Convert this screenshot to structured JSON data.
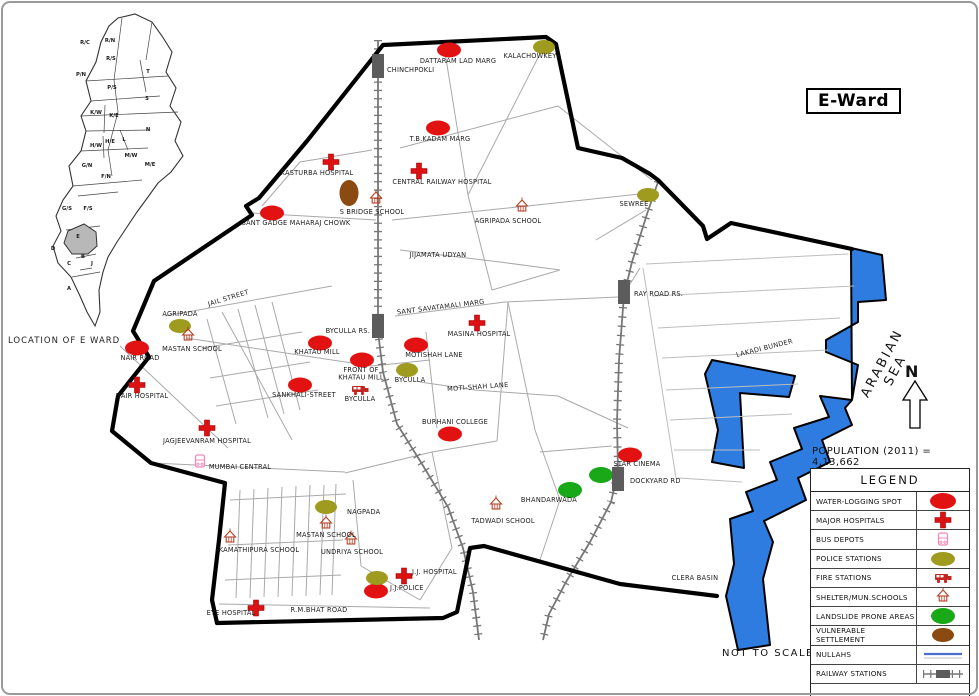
{
  "title": {
    "ward_box": "E-Ward"
  },
  "annotations": {
    "population": "POPULATION (2011) = 4,13,662",
    "not_to_scale": "NOT TO SCALE",
    "sea_label": "ARABIAN SEA",
    "north": "N"
  },
  "colors": {
    "water_red": "#e31212",
    "hospital_red": "#dd1111",
    "police_olive": "#9e9b1f",
    "landslide_green": "#18a818",
    "vulnerable_brown": "#8a4a12",
    "bus_pink": "#ef86b8",
    "fire_red": "#c22620",
    "shelter_red": "#b5422a",
    "rail_gray": "#5c5c5c",
    "sea_blue": "#2f7ce0",
    "nullah_blue": "#4a6fd0",
    "boundary_black": "#000000"
  },
  "inset": {
    "caption": "LOCATION OF E WARD",
    "highlighted_ward": "E",
    "wards": [
      {
        "t": "R/N",
        "x": 110,
        "y": 42
      },
      {
        "t": "R/C",
        "x": 85,
        "y": 44
      },
      {
        "t": "R/S",
        "x": 111,
        "y": 60
      },
      {
        "t": "P/N",
        "x": 81,
        "y": 76
      },
      {
        "t": "T",
        "x": 148,
        "y": 73
      },
      {
        "t": "P/S",
        "x": 112,
        "y": 89
      },
      {
        "t": "S",
        "x": 147,
        "y": 100
      },
      {
        "t": "K/W",
        "x": 96,
        "y": 114
      },
      {
        "t": "K/E",
        "x": 114,
        "y": 117
      },
      {
        "t": "N",
        "x": 148,
        "y": 131
      },
      {
        "t": "H/W",
        "x": 96,
        "y": 147
      },
      {
        "t": "H/E",
        "x": 110,
        "y": 143
      },
      {
        "t": "L",
        "x": 124,
        "y": 141
      },
      {
        "t": "M/W",
        "x": 131,
        "y": 157
      },
      {
        "t": "M/E",
        "x": 150,
        "y": 166
      },
      {
        "t": "G/N",
        "x": 87,
        "y": 167
      },
      {
        "t": "F/N",
        "x": 106,
        "y": 178
      },
      {
        "t": "G/S",
        "x": 67,
        "y": 210
      },
      {
        "t": "F/S",
        "x": 88,
        "y": 210
      },
      {
        "t": "E",
        "x": 78,
        "y": 238
      },
      {
        "t": "D",
        "x": 53,
        "y": 250
      },
      {
        "t": "B",
        "x": 83,
        "y": 258
      },
      {
        "t": "C",
        "x": 69,
        "y": 265
      },
      {
        "t": "J",
        "x": 92,
        "y": 265
      },
      {
        "t": "A",
        "x": 69,
        "y": 290
      }
    ]
  },
  "legend": {
    "title": "LEGEND",
    "rows": [
      {
        "label": "WATER-LOGGING SPOT",
        "symbol": "water"
      },
      {
        "label": "MAJOR HOSPITALS",
        "symbol": "hosp"
      },
      {
        "label": "BUS DEPOTS",
        "symbol": "bus"
      },
      {
        "label": "POLICE STATIONS",
        "symbol": "police"
      },
      {
        "label": "FIRE STATIONS",
        "symbol": "fire"
      },
      {
        "label": "SHELTER/MUN.SCHOOLS",
        "symbol": "shelter"
      },
      {
        "label": "LANDSLIDE PRONE AREAS",
        "symbol": "land"
      },
      {
        "label": "VULNERABLE SETTLEMENT",
        "symbol": "vuln"
      },
      {
        "label": "NULLAHS",
        "symbol": "nullah"
      },
      {
        "label": "RAILWAY STATIONS",
        "symbol": "railsym"
      }
    ]
  },
  "map": {
    "features": [
      {
        "type": "water",
        "x": 449,
        "y": 50,
        "label": [
          "DATTARAM LAD MARG"
        ],
        "lx": 458,
        "ly": 63
      },
      {
        "type": "water",
        "x": 438,
        "y": 128,
        "label": [
          "T.B.KADAM MARG"
        ],
        "lx": 440,
        "ly": 141
      },
      {
        "type": "water",
        "x": 272,
        "y": 213,
        "label": [
          "SANT GADGE MAHARAJ CHOWK"
        ],
        "lx": 296,
        "ly": 225
      },
      {
        "type": "water",
        "x": 137,
        "y": 348,
        "label": [
          "NAIR ROAD"
        ],
        "lx": 140,
        "ly": 360
      },
      {
        "type": "water",
        "x": 320,
        "y": 343,
        "label": [
          "KHATAU MILL"
        ],
        "lx": 317,
        "ly": 354
      },
      {
        "type": "water",
        "x": 362,
        "y": 360,
        "label": [
          "FRONT OF",
          "KHATAU MILL"
        ],
        "lx": 361,
        "ly": 372
      },
      {
        "type": "water",
        "x": 300,
        "y": 385,
        "label": [
          "SANKHALI-STREET"
        ],
        "lx": 304,
        "ly": 397
      },
      {
        "type": "water",
        "x": 416,
        "y": 345,
        "label": [
          "MOTISHAH LANE"
        ],
        "lx": 434,
        "ly": 357
      },
      {
        "type": "water",
        "x": 450,
        "y": 434,
        "label": [
          "BURHANI COLLEGE"
        ],
        "lx": 455,
        "ly": 424
      },
      {
        "type": "water",
        "x": 630,
        "y": 455,
        "label": [
          "STAR CINEMA"
        ],
        "lx": 637,
        "ly": 466
      },
      {
        "type": "water",
        "x": 376,
        "y": 591
      },
      {
        "type": "hosp",
        "x": 331,
        "y": 162,
        "label": [
          "KASTURBA HOSPITAL"
        ],
        "lx": 317,
        "ly": 175
      },
      {
        "type": "hosp",
        "x": 419,
        "y": 171,
        "label": [
          "CENTRAL RAILWAY HOSPITAL"
        ],
        "lx": 442,
        "ly": 184
      },
      {
        "type": "hosp",
        "x": 477,
        "y": 323,
        "label": [
          "MASINA HOSPITAL"
        ],
        "lx": 479,
        "ly": 336
      },
      {
        "type": "hosp",
        "x": 137,
        "y": 385,
        "label": [
          "NAIR HOSPITAL"
        ],
        "lx": 142,
        "ly": 398
      },
      {
        "type": "hosp",
        "x": 207,
        "y": 428,
        "label": [
          "JAGJEEVANRAM HOSPITAL"
        ],
        "lx": 207,
        "ly": 443
      },
      {
        "type": "hosp",
        "x": 404,
        "y": 576,
        "label": [
          "J.J. HOSPITAL"
        ],
        "lx": 412,
        "ly": 574,
        "anchor": "start"
      },
      {
        "type": "hosp",
        "x": 256,
        "y": 608,
        "label": [
          "EYE HOSPITAL"
        ],
        "lx": 231,
        "ly": 615
      },
      {
        "type": "bus",
        "x": 200,
        "y": 461,
        "label": [
          "MUMBAI CENTRAL"
        ],
        "lx": 240,
        "ly": 469
      },
      {
        "type": "police",
        "x": 544,
        "y": 47,
        "label": [
          "KALACHOWKEY"
        ],
        "lx": 530,
        "ly": 58
      },
      {
        "type": "police",
        "x": 648,
        "y": 195,
        "label": [
          "SEWREE"
        ],
        "lx": 634,
        "ly": 206
      },
      {
        "type": "police",
        "x": 180,
        "y": 326,
        "label": [
          "AGRIPADA"
        ],
        "lx": 180,
        "ly": 316
      },
      {
        "type": "police",
        "x": 407,
        "y": 370,
        "label": [
          "BYCULLA"
        ],
        "lx": 410,
        "ly": 382
      },
      {
        "type": "police",
        "x": 326,
        "y": 507,
        "label": [
          "NAGPADA"
        ],
        "lx": 347,
        "ly": 514,
        "anchor": "start"
      },
      {
        "type": "police",
        "x": 377,
        "y": 578,
        "label": [
          "J.J.POLICE"
        ],
        "lx": 390,
        "ly": 590,
        "anchor": "start"
      },
      {
        "type": "fire",
        "x": 360,
        "y": 390,
        "label": [
          "BYCULLA"
        ],
        "lx": 360,
        "ly": 401
      },
      {
        "type": "shelter",
        "x": 376,
        "y": 199,
        "label": [
          "S BRIDGE SCHOOL"
        ],
        "lx": 372,
        "ly": 214
      },
      {
        "type": "shelter",
        "x": 522,
        "y": 207,
        "label": [
          "AGRIPADA SCHOOL"
        ],
        "lx": 508,
        "ly": 223
      },
      {
        "type": "shelter",
        "x": 188,
        "y": 336,
        "label": [
          "MASTAN SCHOOL"
        ],
        "lx": 192,
        "ly": 351
      },
      {
        "type": "shelter",
        "x": 326,
        "y": 524,
        "label": [
          "MASTAN SCHOOL"
        ],
        "lx": 326,
        "ly": 537
      },
      {
        "type": "shelter",
        "x": 230,
        "y": 538,
        "label": [
          "KAMATHIPURA SCHOOL"
        ],
        "lx": 259,
        "ly": 552
      },
      {
        "type": "shelter",
        "x": 351,
        "y": 540,
        "label": [
          "UNDRIYA SCHOOL"
        ],
        "lx": 352,
        "ly": 554
      },
      {
        "type": "shelter",
        "x": 496,
        "y": 505,
        "label": [
          "TADWADI SCHOOL"
        ],
        "lx": 503,
        "ly": 523
      },
      {
        "type": "land",
        "x": 570,
        "y": 490
      },
      {
        "type": "land",
        "x": 601,
        "y": 475
      },
      {
        "type": "vuln",
        "x": 349,
        "y": 193,
        "tall": true
      },
      {
        "type": "rail",
        "x": 378,
        "y": 66,
        "label": [
          "CHINCHPOKLI"
        ],
        "lx": 387,
        "ly": 72,
        "anchor": "start"
      },
      {
        "type": "rail",
        "x": 378,
        "y": 326,
        "label": [
          "BYCULLA RS."
        ],
        "lx": 370,
        "ly": 333,
        "anchor": "end"
      },
      {
        "type": "rail",
        "x": 624,
        "y": 292,
        "label": [
          "RAY ROAD RS."
        ],
        "lx": 634,
        "ly": 296,
        "anchor": "start"
      },
      {
        "type": "rail",
        "x": 618,
        "y": 479,
        "label": [
          "DOCKYARD RD"
        ],
        "lx": 630,
        "ly": 483,
        "anchor": "start"
      }
    ],
    "road_labels": [
      {
        "text": "JAIL STREET",
        "x": 229,
        "y": 300,
        "rot": -17
      },
      {
        "text": "JIJAMATA UDYAN",
        "x": 438,
        "y": 257
      },
      {
        "text": "SANT SAVATAMALI MARG",
        "x": 441,
        "y": 309,
        "rot": -7
      },
      {
        "text": "MOTI-SHAH LANE",
        "x": 478,
        "y": 389,
        "rot": -4
      },
      {
        "text": "LAKADI BUNDER",
        "x": 765,
        "y": 350,
        "rot": -14
      },
      {
        "text": "R.M.BHAT ROAD",
        "x": 319,
        "y": 612
      },
      {
        "text": "CLERA BASIN",
        "x": 695,
        "y": 580
      },
      {
        "text": "BHANDARWADA",
        "x": 549,
        "y": 502
      }
    ]
  }
}
